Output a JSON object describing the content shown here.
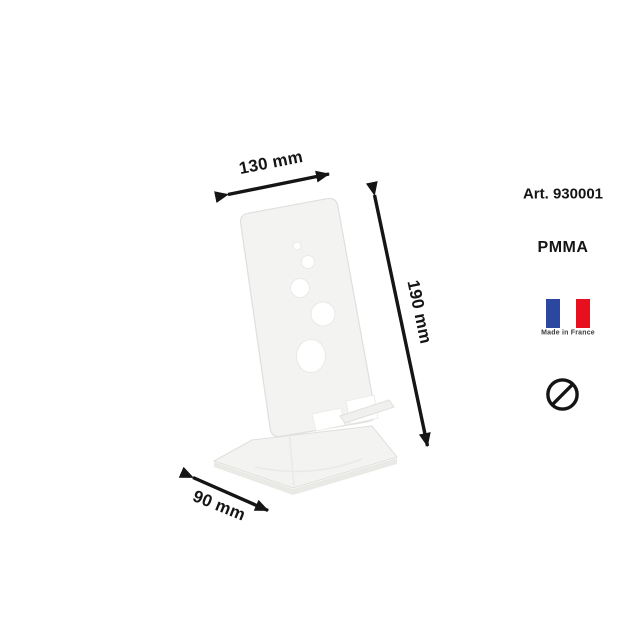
{
  "product": {
    "image_alt": "transparent acrylic phone stand with five round holes",
    "art_number": "Art. 930001",
    "material": "PMMA"
  },
  "dimensions": {
    "width_label": "130 mm",
    "height_label": "190 mm",
    "depth_label": "90 mm"
  },
  "badges": {
    "made_in_label": "Made in France",
    "flag_icon": "french-flag-icon",
    "prohibition_icon": "no-symbol-icon"
  },
  "colors": {
    "ink": "#151515",
    "made_in_text": "#3c3c3c",
    "flag_blue": "#2b479f",
    "flag_red": "#e8101e",
    "plastic_fill": "#f3f3f1",
    "plastic_edge": "#dfdfdd",
    "plastic_shadow": "#e9e9e6",
    "plastic_lip": "#f0f0ee"
  }
}
